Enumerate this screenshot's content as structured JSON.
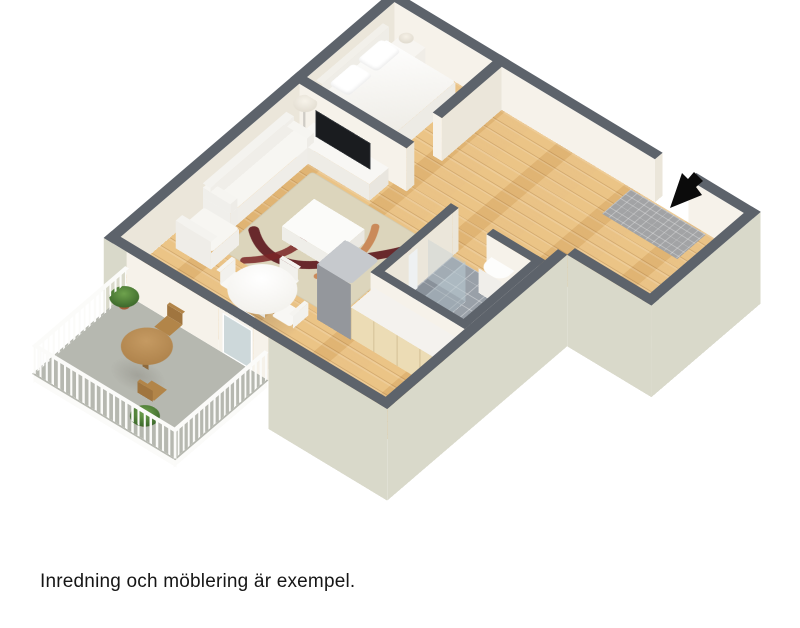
{
  "caption": "Inredning och möblering är exempel.",
  "floorplan": {
    "view": "3D isometric floor plan",
    "rooms": [
      "bedroom",
      "living-room",
      "dining-area",
      "kitchen",
      "bathroom",
      "hallway",
      "entrance",
      "balcony"
    ],
    "furniture": [
      "double-bed",
      "pillows",
      "nightstand",
      "table-lamp",
      "tv-stand",
      "tv",
      "sofa",
      "armchair",
      "coffee-table",
      "rug",
      "floor-lamp",
      "dining-table",
      "dining-chairs",
      "kitchen-counter",
      "fridge",
      "bathroom-sink",
      "shower",
      "doormat",
      "balcony-table",
      "balcony-chairs",
      "potted-plants"
    ],
    "icons": [
      "entrance-arrow-icon"
    ],
    "colors": {
      "wood_floor": "#e8be7d",
      "wall_top": "#5d636b",
      "wall_face": "#f6f2ea",
      "exterior_wall": "#d9d9ca",
      "bathroom_tile": "#99a0a8",
      "balcony_floor": "#b6b8b0",
      "arrow": "#0b0b0b",
      "background": "#ffffff"
    }
  }
}
